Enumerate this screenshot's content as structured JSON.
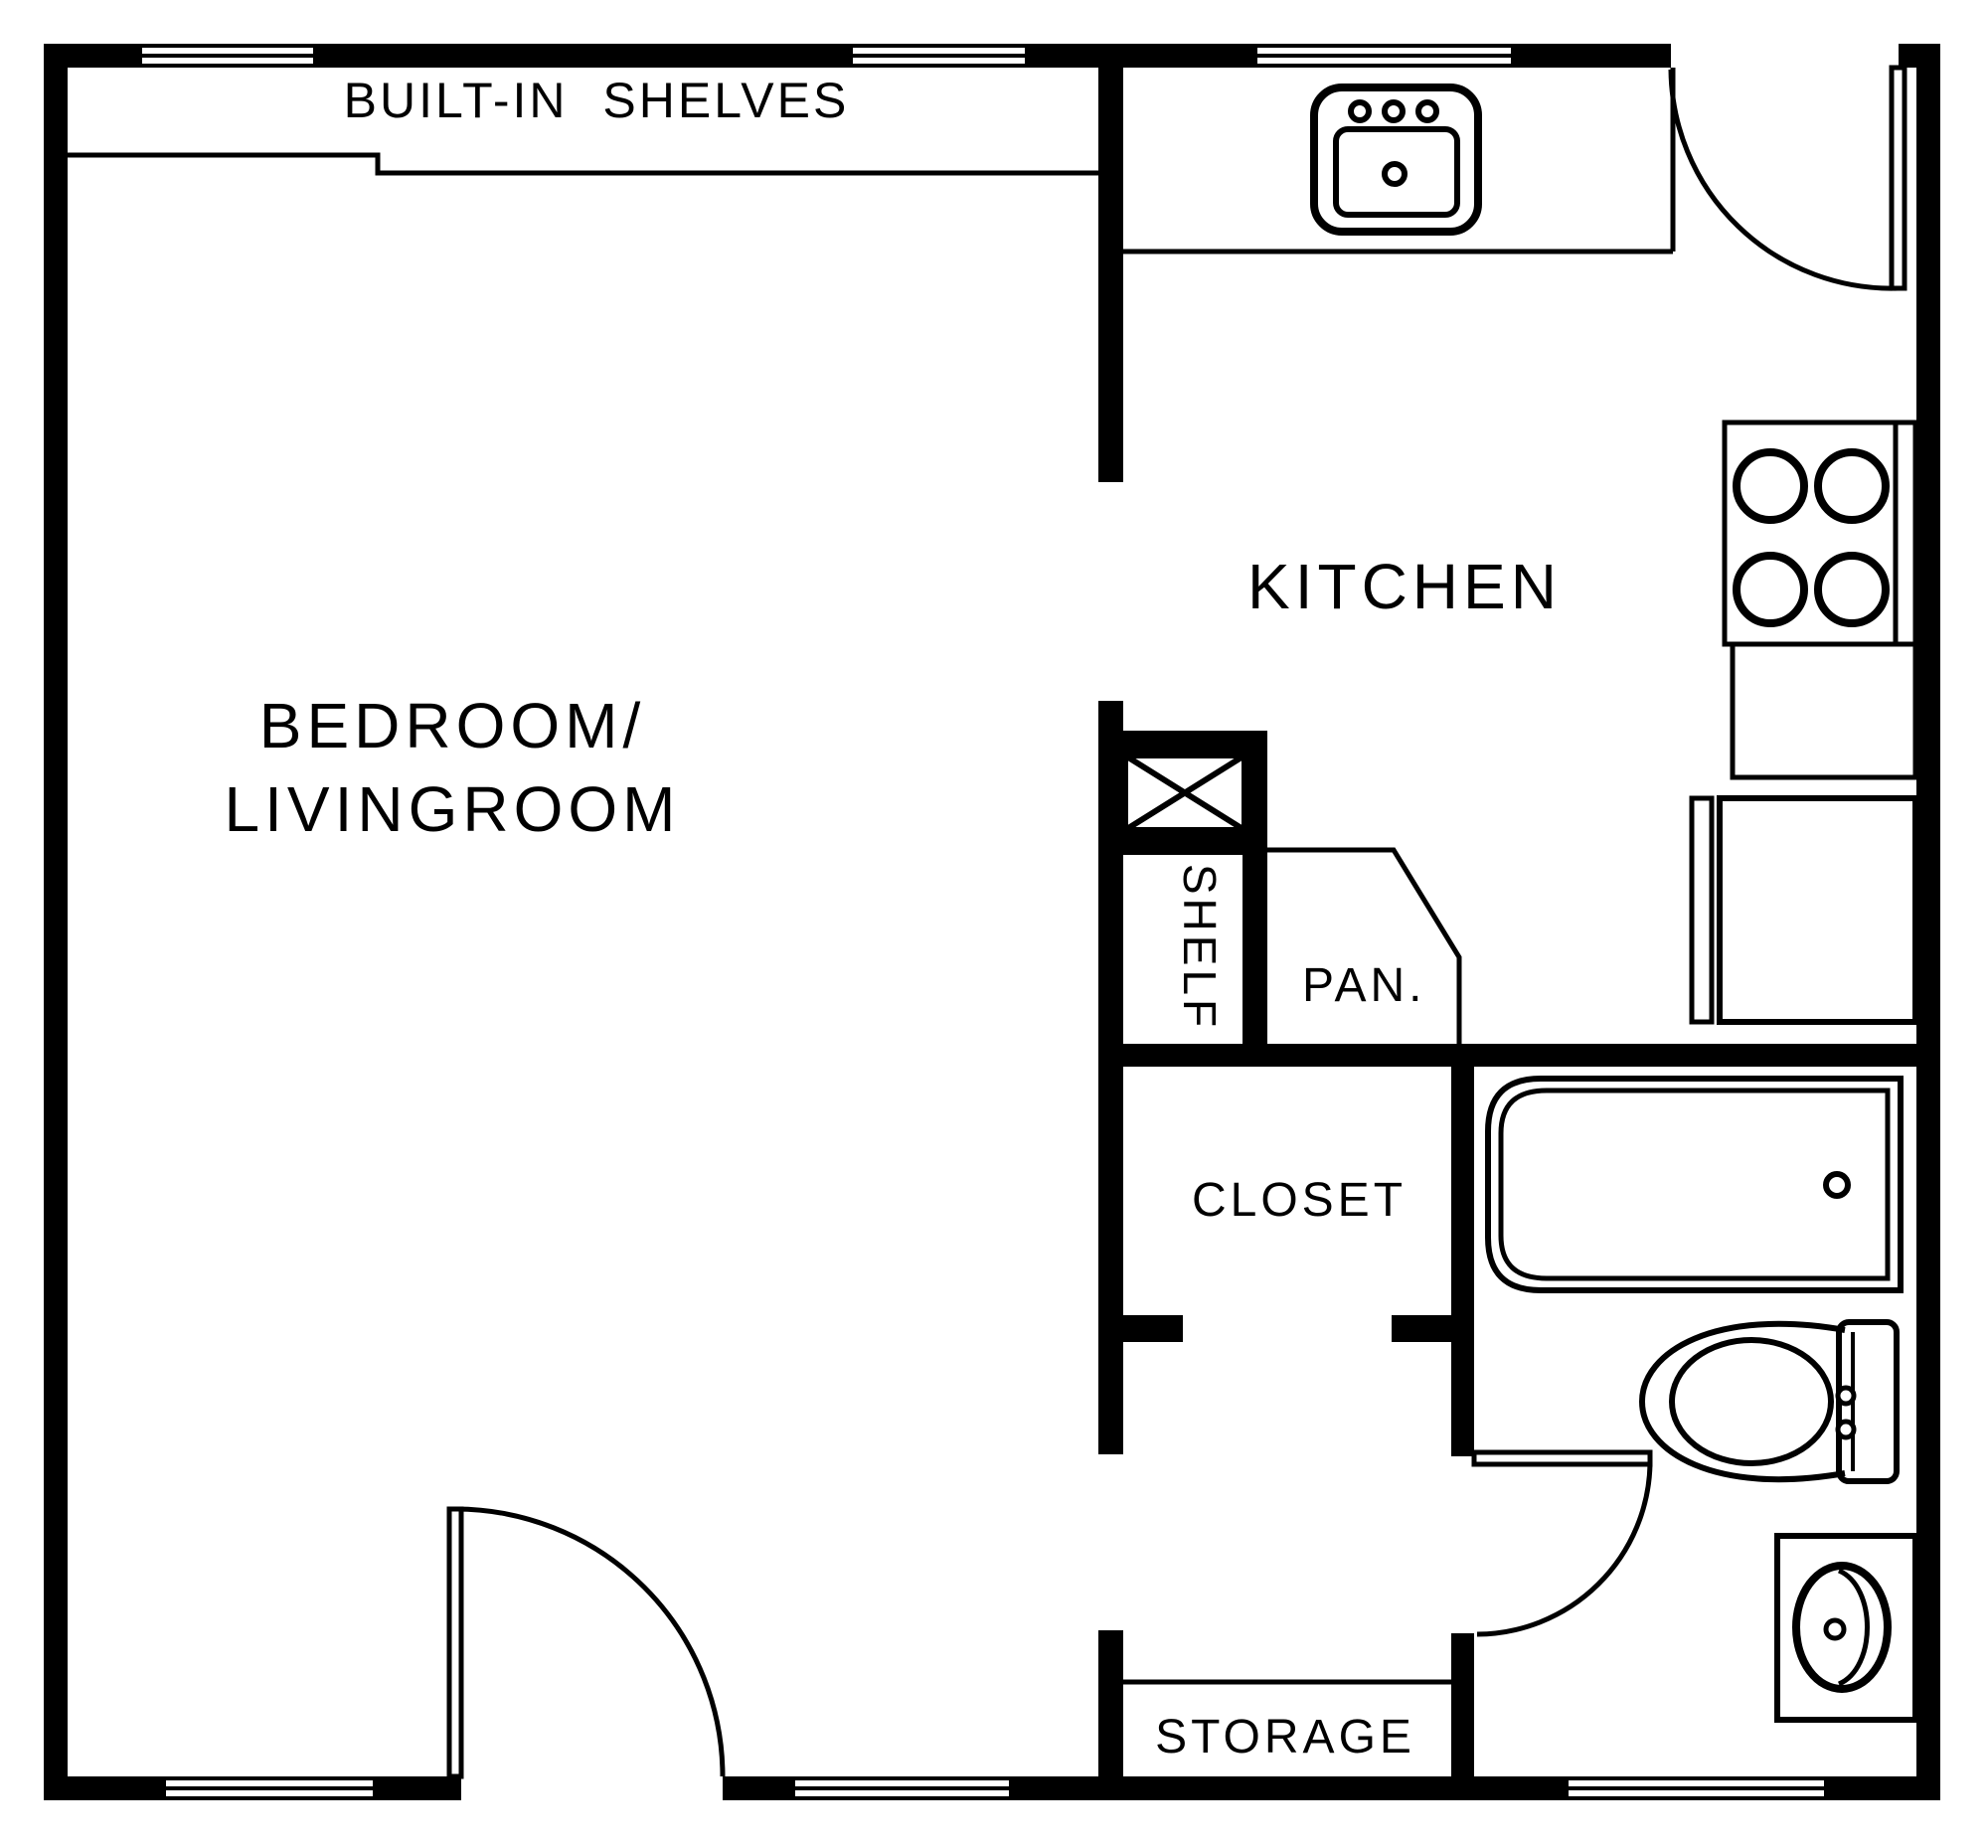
{
  "document": {
    "type": "apartment-floor-plan",
    "colors": {
      "ink": "#000000",
      "background": "#ffffff"
    }
  },
  "labels": {
    "built_in_shelves": "BUILT-IN SHELVES",
    "kitchen": "KITCHEN",
    "bedroom_line1": "BEDROOM/",
    "bedroom_line2": "LIVINGROOM",
    "shelf": "SHELF",
    "pantry": "PAN.",
    "closet": "CLOSET",
    "storage": "STORAGE"
  },
  "rooms": [
    {
      "name": "Bedroom / Livingroom"
    },
    {
      "name": "Kitchen"
    },
    {
      "name": "Closet"
    },
    {
      "name": "Pantry"
    },
    {
      "name": "Bathroom"
    },
    {
      "name": "Storage"
    }
  ],
  "fixtures": [
    {
      "name": "built-in shelves"
    },
    {
      "name": "kitchen sink"
    },
    {
      "name": "stove (4 burners)"
    },
    {
      "name": "oven-counter"
    },
    {
      "name": "refrigerator"
    },
    {
      "name": "water-heater (x-box)"
    },
    {
      "name": "bathtub"
    },
    {
      "name": "toilet"
    },
    {
      "name": "bathroom sink"
    }
  ]
}
